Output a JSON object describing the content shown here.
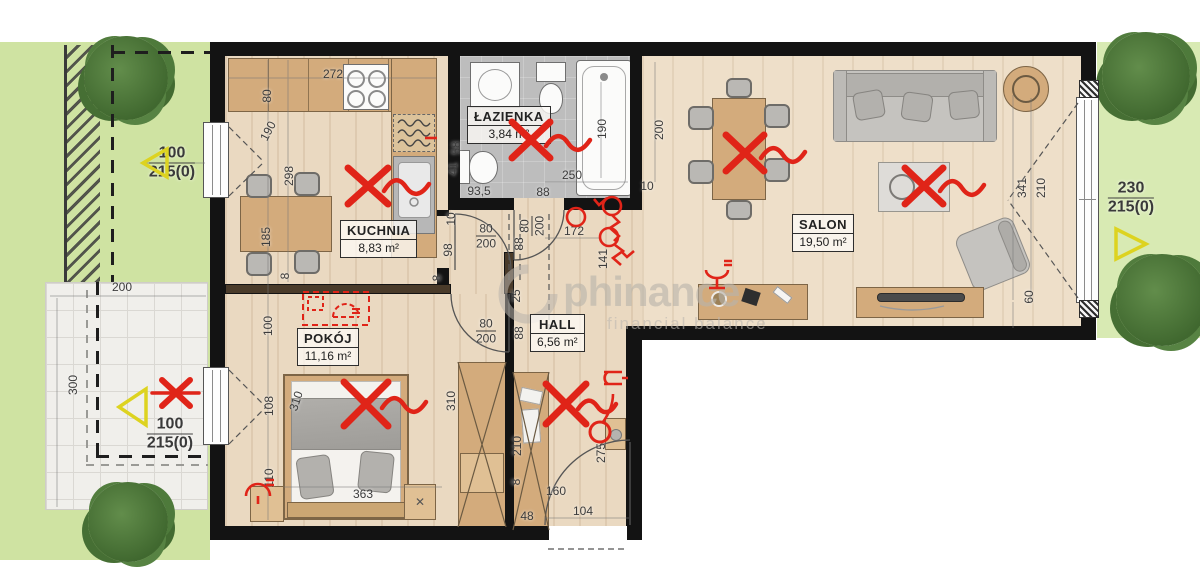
{
  "watermark": {
    "brand": "phinance",
    "tagline": "financial balance"
  },
  "rooms": [
    {
      "name": "KUCHNIA",
      "area": "8,83 m²"
    },
    {
      "name": "ŁAZIENKA",
      "area": "3,84 m²"
    },
    {
      "name": "SALON",
      "area": "19,50 m²"
    },
    {
      "name": "POKÓJ",
      "area": "11,16 m²"
    },
    {
      "name": "HALL",
      "area": "6,56 m²"
    }
  ],
  "dimensions": [
    {
      "text": "80",
      "x": 267,
      "y": 96,
      "rot": -90
    },
    {
      "text": "272",
      "x": 333,
      "y": 74,
      "rot": 0
    },
    {
      "text": "190",
      "x": 268,
      "y": 131,
      "rot": -62
    },
    {
      "text": "298",
      "x": 289,
      "y": 176,
      "rot": -90
    },
    {
      "text": "185",
      "x": 266,
      "y": 237,
      "rot": -90
    },
    {
      "text": "8",
      "x": 285,
      "y": 276,
      "rot": -90
    },
    {
      "text": "100",
      "x": 268,
      "y": 326,
      "rot": -90
    },
    {
      "text": "108",
      "x": 269,
      "y": 406,
      "rot": -90
    },
    {
      "text": "110",
      "x": 269,
      "y": 478,
      "rot": -90
    },
    {
      "text": "58",
      "x": 456,
      "y": 148,
      "rot": -90
    },
    {
      "text": "41",
      "x": 453,
      "y": 169,
      "rot": -90
    },
    {
      "text": "93,5",
      "x": 479,
      "y": 191,
      "rot": 0
    },
    {
      "text": "88",
      "x": 543,
      "y": 192,
      "rot": 0
    },
    {
      "text": "250",
      "x": 572,
      "y": 175,
      "rot": 0
    },
    {
      "text": "190",
      "x": 602,
      "y": 129,
      "rot": -90
    },
    {
      "text": "200",
      "x": 659,
      "y": 130,
      "rot": -90
    },
    {
      "text": "10",
      "x": 647,
      "y": 186,
      "rot": 0
    },
    {
      "text": "10",
      "x": 451,
      "y": 219,
      "rot": -90
    },
    {
      "text": "98",
      "x": 448,
      "y": 250,
      "rot": -90
    },
    {
      "text": "8",
      "x": 437,
      "y": 278,
      "rot": -90
    },
    {
      "text": "172",
      "x": 574,
      "y": 231,
      "rot": 0
    },
    {
      "text": "141",
      "x": 603,
      "y": 259,
      "rot": -90
    },
    {
      "text": "88",
      "x": 519,
      "y": 244,
      "rot": -90
    },
    {
      "text": "25",
      "x": 516,
      "y": 296,
      "rot": -90
    },
    {
      "text": "88",
      "x": 519,
      "y": 333,
      "rot": -90
    },
    {
      "text": "310",
      "x": 296,
      "y": 401,
      "rot": -72
    },
    {
      "text": "363",
      "x": 363,
      "y": 494,
      "rot": 0
    },
    {
      "text": "310",
      "x": 451,
      "y": 401,
      "rot": -90
    },
    {
      "text": "210",
      "x": 517,
      "y": 446,
      "rot": -90
    },
    {
      "text": "8",
      "x": 516,
      "y": 482,
      "rot": -90
    },
    {
      "text": "48",
      "x": 527,
      "y": 516,
      "rot": 0
    },
    {
      "text": "160",
      "x": 556,
      "y": 491,
      "rot": 0
    },
    {
      "text": "104",
      "x": 583,
      "y": 511,
      "rot": 0
    },
    {
      "text": "275",
      "x": 601,
      "y": 453,
      "rot": -90
    },
    {
      "text": "341",
      "x": 1022,
      "y": 188,
      "rot": -90
    },
    {
      "text": "210",
      "x": 1041,
      "y": 188,
      "rot": -90
    },
    {
      "text": "60",
      "x": 1029,
      "y": 297,
      "rot": -90
    },
    {
      "text": "200",
      "x": 122,
      "y": 287,
      "rot": 0
    },
    {
      "text": "300",
      "x": 73,
      "y": 385,
      "rot": -90
    }
  ],
  "door_size_labels": [
    {
      "top": "80",
      "bottom": "200",
      "x": 486,
      "y": 236,
      "rot": 0
    },
    {
      "top": "80",
      "bottom": "200",
      "x": 486,
      "y": 331,
      "rot": 0
    },
    {
      "top": "80",
      "bottom": "200",
      "x": 532,
      "y": 226,
      "rot": -90
    }
  ],
  "outdoor_markers": [
    {
      "name": "garden-left-marker",
      "top": "100",
      "bottom": "215(0)",
      "x": 172,
      "y": 163
    },
    {
      "name": "terrace-marker",
      "top": "100",
      "bottom": "215(0)",
      "x": 170,
      "y": 434
    },
    {
      "name": "garden-right-marker",
      "top": "230",
      "bottom": "215(0)",
      "x": 1131,
      "y": 198
    }
  ],
  "accent_colors": {
    "annotation_red": "#e02418",
    "marker_yellow": "#ddd320",
    "wall_black": "#131313"
  }
}
